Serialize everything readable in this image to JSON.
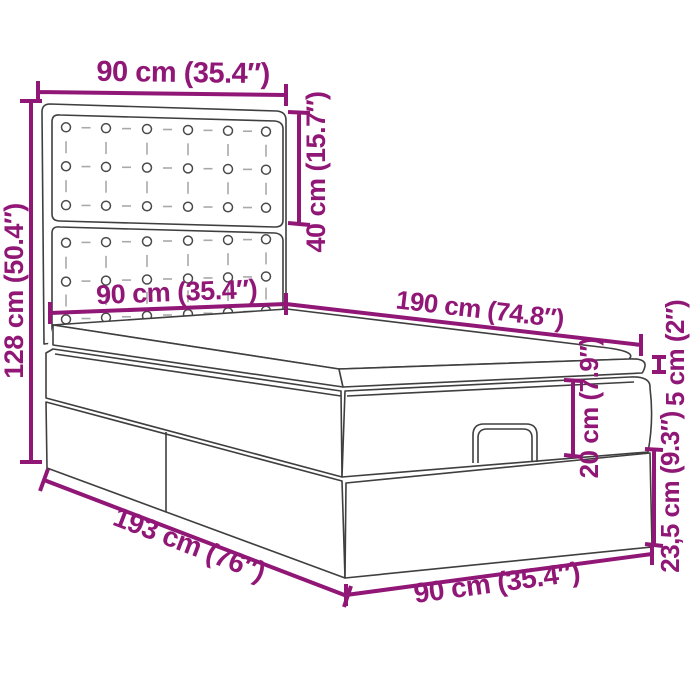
{
  "diagram": {
    "subject": "ottoman storage bed with tufted headboard - dimension drawing",
    "colors": {
      "dimension_color": "#911777",
      "outline_color": "#3F3F3F",
      "background": "#FFFFFF"
    },
    "dimensions": {
      "headboard_width": "90 cm (35.4″)",
      "headboard_panel_height": "40 cm (15.7″)",
      "overall_height": "128 cm (50.4″)",
      "bed_surface_width": "90 cm (35.4″)",
      "surface_length": "190 cm (74.8″)",
      "mattress_thickness": "5 cm (2″)",
      "frame_height": "20 cm (7.9″)",
      "base_height": "23,5 cm (9.3″)",
      "overall_length": "193 cm (76″)",
      "base_width": "90 cm (35.4″)"
    }
  }
}
